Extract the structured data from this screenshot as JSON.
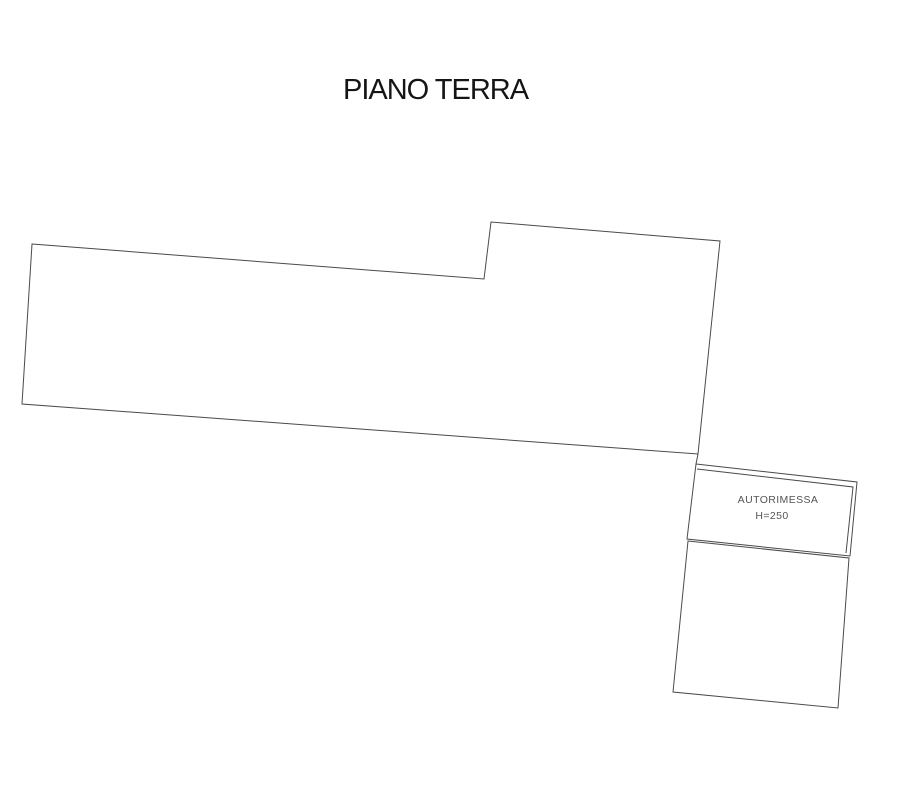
{
  "plan": {
    "title": "PIANO TERRA",
    "colors": {
      "line": "#4a4a4a",
      "title_text": "#151515",
      "label_text": "#555555",
      "background": "#ffffff"
    },
    "garage": {
      "name": "AUTORIMESSA",
      "height_label": "H=250"
    },
    "shapes": [
      {
        "id": "main-floor-outline",
        "type": "polygon",
        "points": [
          [
            32,
            244
          ],
          [
            484,
            279
          ],
          [
            491,
            222
          ],
          [
            720,
            241
          ],
          [
            698,
            454
          ],
          [
            22,
            404
          ]
        ]
      },
      {
        "id": "garage-wall-connector",
        "type": "polyline",
        "points": [
          [
            698,
            454
          ],
          [
            696,
            464
          ]
        ]
      },
      {
        "id": "garage-room-outer-wall",
        "type": "polygon",
        "points": [
          [
            696,
            464
          ],
          [
            857,
            482
          ],
          [
            850,
            556
          ],
          [
            687,
            539
          ]
        ]
      },
      {
        "id": "garage-room-inner-wall",
        "type": "polyline",
        "points": [
          [
            697,
            469
          ],
          [
            853,
            487
          ],
          [
            846,
            553
          ]
        ]
      },
      {
        "id": "garage-lower-room-outline",
        "type": "polygon",
        "points": [
          [
            688,
            541
          ],
          [
            849,
            558
          ],
          [
            838,
            708
          ],
          [
            673,
            692
          ]
        ]
      }
    ]
  }
}
